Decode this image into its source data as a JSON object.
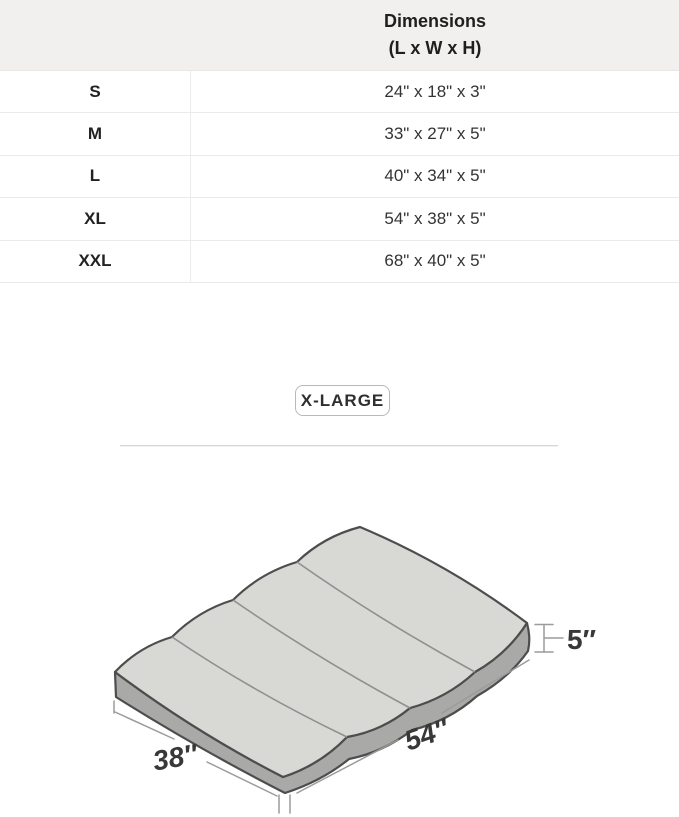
{
  "size_table": {
    "header": {
      "line1": "Dimensions",
      "line2": "(L x W x H)"
    },
    "rows": [
      {
        "size": "S",
        "dimensions": "24\" x 18\" x 3\""
      },
      {
        "size": "M",
        "dimensions": "33\" x 27\" x 5\""
      },
      {
        "size": "L",
        "dimensions": "40\" x 34\" x 5\""
      },
      {
        "size": "XL",
        "dimensions": "54\" x 38\" x 5\""
      },
      {
        "size": "XXL",
        "dimensions": "68\" x 40\" x 5\""
      }
    ]
  },
  "selected_size": {
    "label": "X-LARGE"
  },
  "diagram": {
    "labels": {
      "height": "5″",
      "length": "54″",
      "width": "38″"
    },
    "colors": {
      "top_face": "#d8d8d5",
      "side_face": "#a9a9a7",
      "outline": "#4d4d4d",
      "seam": "#8f8f8d",
      "dimension_line": "#9b9b9b",
      "label_text": "#383838"
    }
  },
  "colors": {
    "header_background": "#f1f0ee",
    "row_border": "#eaeae8",
    "chip_border": "#b9b9b9",
    "divider": "#d6d6d6"
  }
}
